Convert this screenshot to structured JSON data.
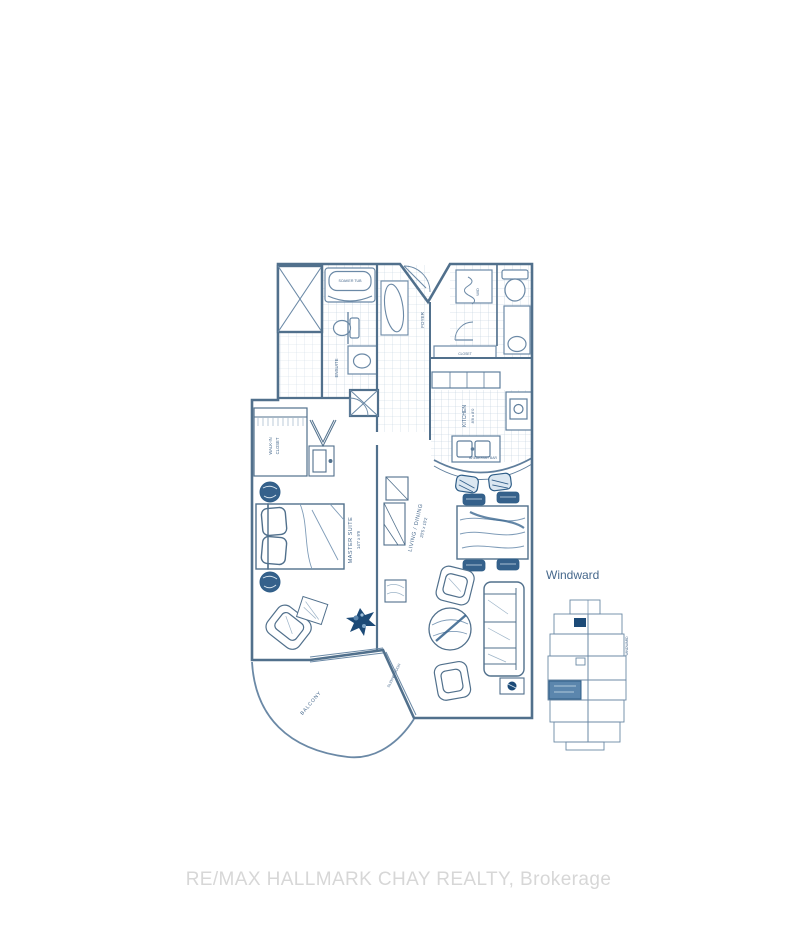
{
  "watermark": {
    "text": "RE/MAX HALLMARK CHAY REALTY, Brokerage"
  },
  "keyplan": {
    "title": "Windward",
    "side_note": "WINDWARD"
  },
  "floorplan": {
    "labels": {
      "master_suite": "MASTER SUITE",
      "master_suite_dims": "14'7 x 9'9",
      "living_dining": "LIVING / DINING",
      "living_dining_dims": "20'5 x 10'2",
      "kitchen": "KITCHEN",
      "kitchen_dims": "8'8 x 8'0",
      "foyer": "FOYER",
      "ensuite": "ENSUITE",
      "walk_in_line1": "WALK-IN",
      "walk_in_line2": "CLOSET",
      "hall_closet": "CLOSET",
      "balcony": "BALCONY",
      "sliding_door": "SLIDING DOOR",
      "laundry": "W/D",
      "soaker_tub": "SOAKER TUB",
      "breakfast_bar": "BREAKFAST BAR"
    },
    "colors": {
      "ink": "#6b89a6",
      "wall": "#51708c",
      "accent": "#1c4a77",
      "highlight": "#5b86ad",
      "tile": "#bccddc"
    }
  }
}
